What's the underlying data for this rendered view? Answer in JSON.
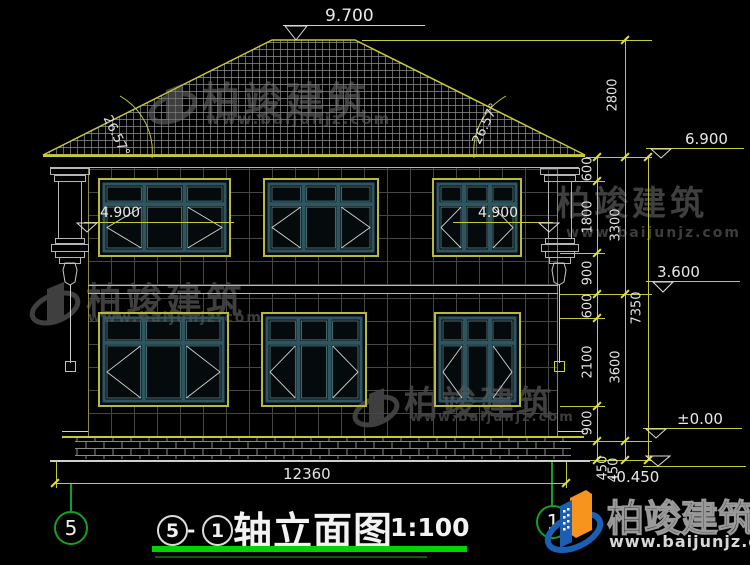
{
  "colors": {
    "background": "#000000",
    "line_yellow": "#c8c838",
    "axis_green": "#15a01f",
    "underline_green": "#00d400",
    "window_teal": "#2e5660",
    "watermark_gray": "#3f3f3f",
    "logo_blue": "#1b5fb5",
    "logo_orange": "#f7941d"
  },
  "levels": {
    "ridge": "9.700",
    "eave": "6.900",
    "transom_left": "4.900",
    "transom_right": "4.900",
    "floor2": "3.600",
    "zero": "±0.00",
    "ground": "-0.450"
  },
  "angles": {
    "left": "26.57°",
    "right": "26.57°"
  },
  "dims": {
    "total_width": "12360",
    "roof_rise": "2800",
    "total_height": "7350",
    "chain_inner": [
      "600",
      "1800",
      "900",
      "600",
      "2100",
      "900",
      "450"
    ],
    "chain_mid": [
      "3300",
      "3600",
      "450"
    ]
  },
  "axes": {
    "left_bubble": "5",
    "right_bubble": "1"
  },
  "title": {
    "axis_a": "5",
    "sep": "-",
    "axis_b": "1",
    "name": "轴立面图",
    "scale": "1:100"
  },
  "watermark": {
    "brand": "柏竣建筑",
    "url": "www.baijunjz.com"
  }
}
